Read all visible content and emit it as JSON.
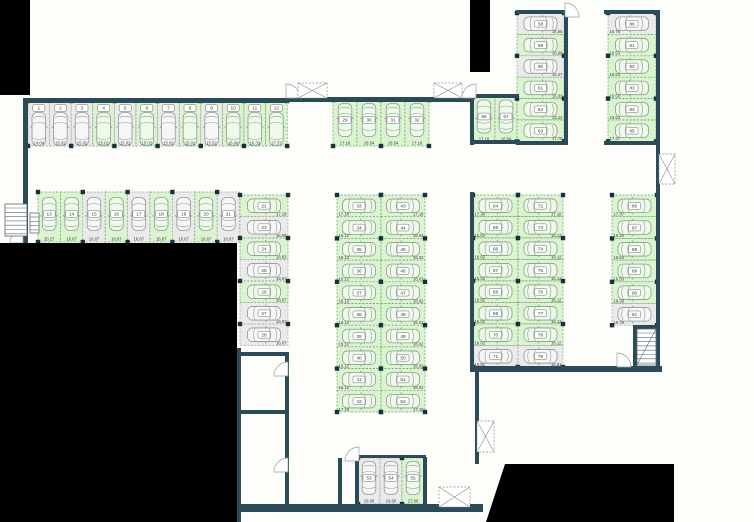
{
  "plan_name": "parking-level-floor-plan",
  "colors": {
    "background": "#fdfdf9",
    "available_fill": "#d9f4cf",
    "available_stroke": "#6f9a6f",
    "occupied_fill": "#eaeaea",
    "occupied_stroke": "#a0a0a0",
    "wall": "#2c4b59",
    "column_square": "#17323d",
    "mask": "#000000",
    "car_outline": "#8f998f",
    "text": "#3c3c3c"
  },
  "icons": {
    "stairs": "stairs-icon",
    "door": "door-arc-icon",
    "shaft": "crossed-shaft-icon",
    "car": "car-icon"
  },
  "groups": [
    {
      "id": "top-row",
      "stalls": [
        {
          "no": "1",
          "area": "14.04",
          "status": "occupied"
        },
        {
          "no": "2",
          "area": "15.02",
          "status": "occupied"
        },
        {
          "no": "3",
          "area": "15.02",
          "status": "occupied"
        },
        {
          "no": "4",
          "area": "15.02",
          "status": "available"
        },
        {
          "no": "5",
          "area": "15.02",
          "status": "occupied"
        },
        {
          "no": "6",
          "area": "15.02",
          "status": "available"
        },
        {
          "no": "7",
          "area": "15.02",
          "status": "occupied"
        },
        {
          "no": "8",
          "area": "15.02",
          "status": "available"
        },
        {
          "no": "9",
          "area": "15.52",
          "status": "occupied"
        },
        {
          "no": "10",
          "area": "16.06",
          "status": "available"
        },
        {
          "no": "11",
          "area": "16.33",
          "status": "available"
        },
        {
          "no": "12",
          "area": "17.37",
          "status": "available"
        }
      ]
    },
    {
      "id": "second-row",
      "stalls": [
        {
          "no": "13",
          "area": "20.27",
          "status": "available"
        },
        {
          "no": "14",
          "area": "16.67",
          "status": "available"
        },
        {
          "no": "15",
          "area": "16.67",
          "status": "occupied"
        },
        {
          "no": "16",
          "area": "16.67",
          "status": "available"
        },
        {
          "no": "17",
          "area": "16.67",
          "status": "occupied"
        },
        {
          "no": "18",
          "area": "16.67",
          "status": "available"
        },
        {
          "no": "19",
          "area": "16.67",
          "status": "occupied"
        },
        {
          "no": "20",
          "area": "16.67",
          "status": "available"
        },
        {
          "no": "21",
          "area": "16.67",
          "status": "occupied"
        }
      ]
    },
    {
      "id": "left-column",
      "stalls": [
        {
          "no": "22",
          "area": "17.18",
          "status": "available"
        },
        {
          "no": "23",
          "area": "16.08",
          "status": "occupied"
        },
        {
          "no": "24",
          "area": "16.63",
          "status": "available"
        },
        {
          "no": "25",
          "area": "16.67",
          "status": "occupied"
        },
        {
          "no": "26",
          "area": "16.67",
          "status": "available"
        },
        {
          "no": "27",
          "area": "16.67",
          "status": "occupied"
        },
        {
          "no": "28",
          "area": "16.07",
          "status": "occupied"
        }
      ]
    },
    {
      "id": "top-middle-row",
      "stalls": [
        {
          "no": "29",
          "area": "17.16",
          "status": "available"
        },
        {
          "no": "30",
          "area": "16.54",
          "status": "available"
        },
        {
          "no": "31",
          "area": "16.54",
          "status": "available"
        },
        {
          "no": "32",
          "area": "17.16",
          "status": "available"
        }
      ]
    },
    {
      "id": "center-left-column",
      "stalls": [
        {
          "no": "33",
          "area": "17.18",
          "status": "available"
        },
        {
          "no": "34",
          "area": "16.12",
          "status": "available"
        },
        {
          "no": "35",
          "area": "16.12",
          "status": "available"
        },
        {
          "no": "36",
          "area": "16.12",
          "status": "available"
        },
        {
          "no": "37",
          "area": "16.12",
          "status": "available"
        },
        {
          "no": "38",
          "area": "16.12",
          "status": "available"
        },
        {
          "no": "39",
          "area": "16.12",
          "status": "available"
        },
        {
          "no": "40",
          "area": "16.12",
          "status": "available"
        },
        {
          "no": "41",
          "area": "16.12",
          "status": "available"
        },
        {
          "no": "42",
          "area": "17.18",
          "status": "available"
        }
      ]
    },
    {
      "id": "center-right-column",
      "stalls": [
        {
          "no": "43",
          "area": "17.18",
          "status": "available"
        },
        {
          "no": "44",
          "area": "16.02",
          "status": "available"
        },
        {
          "no": "45",
          "area": "16.02",
          "status": "available"
        },
        {
          "no": "46",
          "area": "16.02",
          "status": "available"
        },
        {
          "no": "47",
          "area": "16.02",
          "status": "available"
        },
        {
          "no": "48",
          "area": "16.02",
          "status": "available"
        },
        {
          "no": "49",
          "area": "16.02",
          "status": "available"
        },
        {
          "no": "50",
          "area": "16.02",
          "status": "available"
        },
        {
          "no": "51",
          "area": "16.02",
          "status": "available"
        },
        {
          "no": "52",
          "area": "17.18",
          "status": "available"
        }
      ]
    },
    {
      "id": "bottom-middle-row",
      "stalls": [
        {
          "no": "53",
          "area": "16.00",
          "status": "occupied"
        },
        {
          "no": "54",
          "area": "16.00",
          "status": "occupied"
        },
        {
          "no": "55",
          "area": "17.00",
          "status": "available"
        }
      ]
    },
    {
      "id": "upper-right-pair",
      "stalls": [
        {
          "no": "56",
          "area": "17.16",
          "status": "available"
        },
        {
          "no": "57",
          "area": "16.54",
          "status": "available"
        }
      ]
    },
    {
      "id": "upper-right-col-a",
      "stalls": [
        {
          "no": "58",
          "area": "16.65",
          "status": "occupied"
        },
        {
          "no": "59",
          "area": "16.66",
          "status": "available"
        },
        {
          "no": "60",
          "area": "16.27",
          "status": "occupied"
        },
        {
          "no": "61",
          "area": "16.33",
          "status": "available"
        },
        {
          "no": "62",
          "area": "16.12",
          "status": "available"
        },
        {
          "no": "63",
          "area": "17.76",
          "status": "available"
        }
      ]
    },
    {
      "id": "upper-right-col-b",
      "stalls": [
        {
          "no": "80",
          "area": "16.76",
          "status": "occupied"
        },
        {
          "no": "81",
          "area": "16.53",
          "status": "available"
        },
        {
          "no": "82",
          "area": "16.53",
          "status": "available"
        },
        {
          "no": "83",
          "area": "16.53",
          "status": "available"
        },
        {
          "no": "84",
          "area": "16.53",
          "status": "available"
        },
        {
          "no": "85",
          "area": "17.37",
          "status": "available"
        }
      ]
    },
    {
      "id": "mid-right-col-a",
      "stalls": [
        {
          "no": "64",
          "area": "17.30",
          "status": "available"
        },
        {
          "no": "65",
          "area": "16.02",
          "status": "available"
        },
        {
          "no": "66",
          "area": "16.02",
          "status": "available"
        },
        {
          "no": "67",
          "area": "16.02",
          "status": "available"
        },
        {
          "no": "68",
          "area": "16.02",
          "status": "available"
        },
        {
          "no": "69",
          "area": "16.02",
          "status": "available"
        },
        {
          "no": "70",
          "area": "16.02",
          "status": "available"
        },
        {
          "no": "71",
          "area": "16.81",
          "status": "occupied"
        }
      ]
    },
    {
      "id": "mid-right-col-b",
      "stalls": [
        {
          "no": "72",
          "area": "17.18",
          "status": "available"
        },
        {
          "no": "73",
          "area": "16.12",
          "status": "available"
        },
        {
          "no": "74",
          "area": "16.12",
          "status": "available"
        },
        {
          "no": "75",
          "area": "16.12",
          "status": "available"
        },
        {
          "no": "76",
          "area": "16.12",
          "status": "available"
        },
        {
          "no": "77",
          "area": "16.12",
          "status": "available"
        },
        {
          "no": "78",
          "area": "16.12",
          "status": "available"
        },
        {
          "no": "79",
          "area": "16.81",
          "status": "occupied"
        }
      ]
    },
    {
      "id": "far-right-column",
      "stalls": [
        {
          "no": "86",
          "area": "17.37",
          "status": "available"
        },
        {
          "no": "87",
          "area": "16.53",
          "status": "available"
        },
        {
          "no": "88",
          "area": "16.53",
          "status": "available"
        },
        {
          "no": "89",
          "area": "16.53",
          "status": "available"
        },
        {
          "no": "90",
          "area": "16.33",
          "status": "available"
        },
        {
          "no": "91",
          "area": "16.76",
          "status": "occupied"
        }
      ]
    }
  ]
}
